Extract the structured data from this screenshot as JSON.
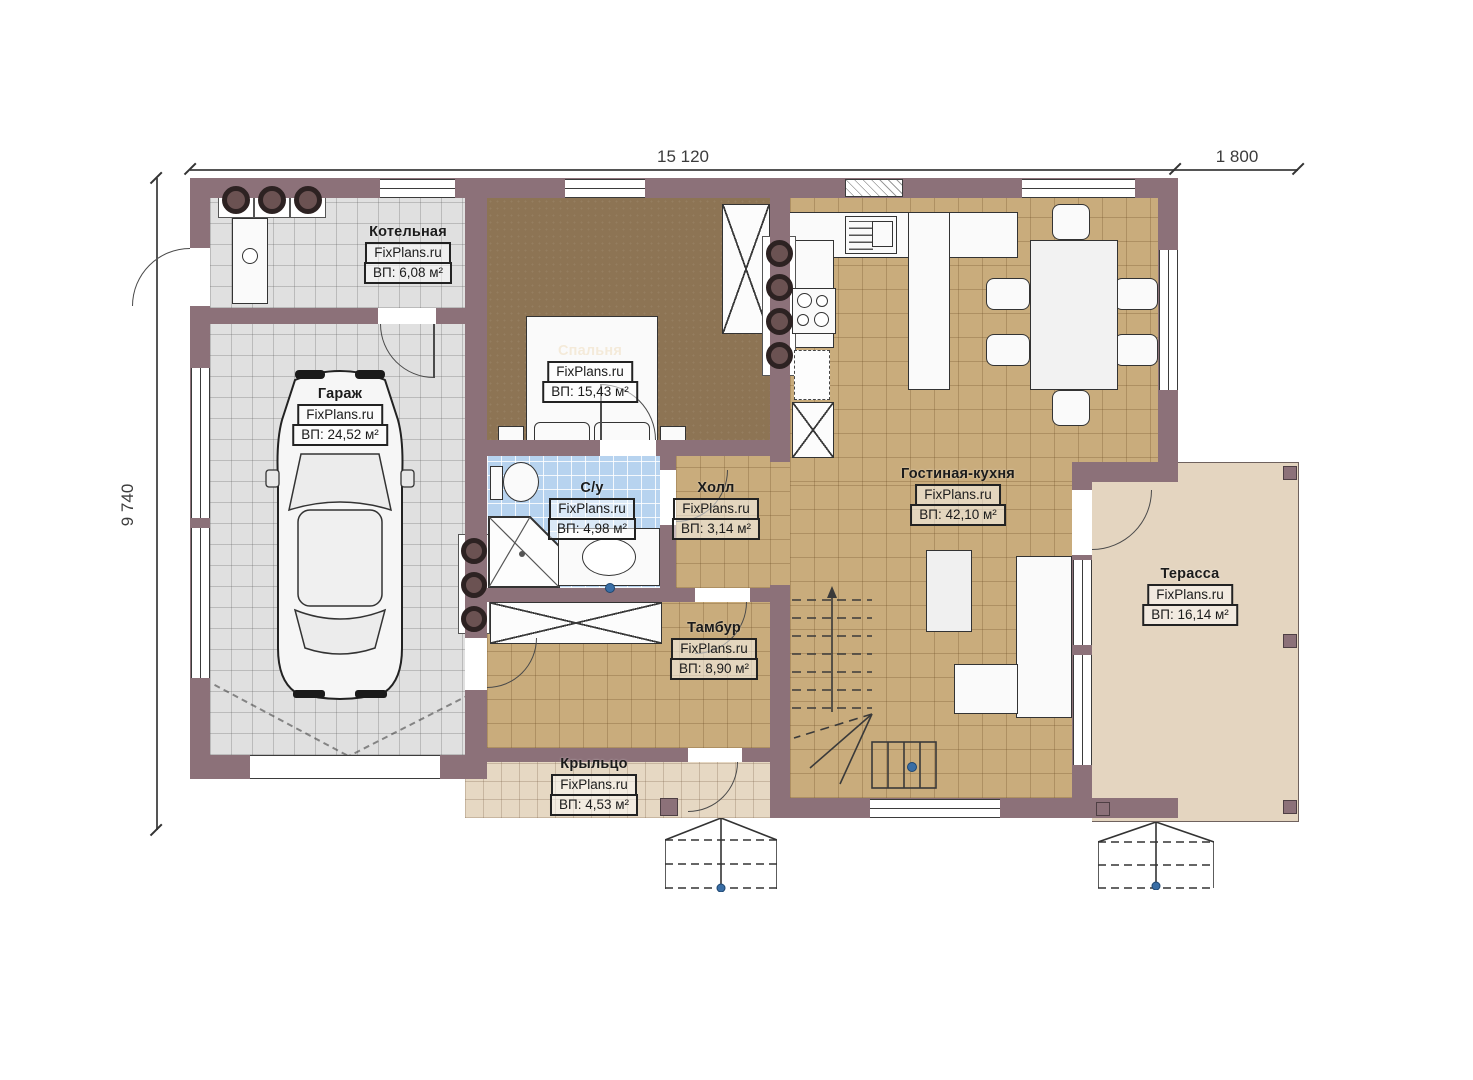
{
  "plan": {
    "dimensions": {
      "width_main": "15 120",
      "width_terrace": "1 800",
      "height": "9 740"
    },
    "rooms": [
      {
        "name": "Котельная",
        "watermark": "FixPlans.ru",
        "area": "ВП: 6,08 м²"
      },
      {
        "name": "Гараж",
        "watermark": "FixPlans.ru",
        "area": "ВП: 24,52 м²"
      },
      {
        "name": "Спальня",
        "watermark": "FixPlans.ru",
        "area": "ВП: 15,43 м²"
      },
      {
        "name": "С/у",
        "watermark": "FixPlans.ru",
        "area": "ВП: 4,98 м²"
      },
      {
        "name": "Холл",
        "watermark": "FixPlans.ru",
        "area": "ВП: 3,14 м²"
      },
      {
        "name": "Гостиная-кухня",
        "watermark": "FixPlans.ru",
        "area": "ВП: 42,10 м²"
      },
      {
        "name": "Тамбур",
        "watermark": "FixPlans.ru",
        "area": "ВП: 8,90 м²"
      },
      {
        "name": "Терасса",
        "watermark": "FixPlans.ru",
        "area": "ВП: 16,14 м²"
      },
      {
        "name": "Крыльцо",
        "watermark": "FixPlans.ru",
        "area": "ВП: 4,53 м²"
      }
    ],
    "colors": {
      "wall": "#8c7179",
      "garage_floor": "#e0e0e0",
      "bedroom_floor": "#8d7454",
      "kitchen_floor": "#c9ac7c",
      "bathroom_floor": "#b7d3ef",
      "porch_floor": "#e6d8c3",
      "terrace_floor": "#e4d5c0",
      "accent_blue": "#3a6ea5"
    }
  }
}
